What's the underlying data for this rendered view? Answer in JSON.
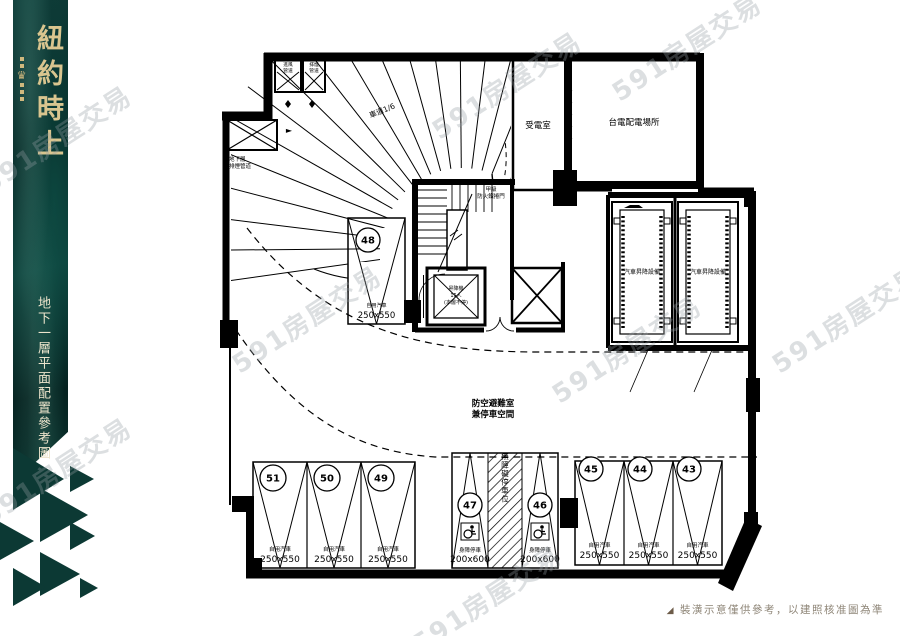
{
  "brand": {
    "title": "紐約時上",
    "crest_glyph": "♛",
    "subtitle": "地下一層平面配置參考圖",
    "panel_color": "#0a332f",
    "accent_color": "#d9c58f"
  },
  "watermark": {
    "text": "591房屋交易"
  },
  "footer": {
    "icon": "◢",
    "text": "裝潢示意僅供參考，以建照核准圖為準"
  },
  "plan": {
    "rooms": {
      "power_room": "受電室",
      "taipower_room": "台電配電場所"
    },
    "ramp_label": "車道1/6",
    "shelter_label_1": "防空避難室",
    "shelter_label_2": "兼停車空間",
    "fire_note_1": "甲級",
    "fire_note_2": "防火鐵捲門",
    "elevator_labels": [
      "昇降機",
      "15人",
      "(本層不停)"
    ],
    "car_lift_label": "汽車昇降設備",
    "shaft_top_labels": [
      [
        "進風",
        "管道"
      ],
      [
        "排煙",
        "管道"
      ]
    ],
    "shaft_left_labels": [
      "地下層",
      "排煙管道"
    ],
    "arrow_glyph": "►",
    "aisle_label": "無障礙停車位",
    "stall_types": {
      "car": "自用汽車",
      "accessible": "身障停車"
    },
    "stall_groups": [
      {
        "id": "g48",
        "numbers": [
          "48"
        ],
        "size": "250x550",
        "type": "car"
      },
      {
        "id": "left",
        "numbers": [
          "51",
          "50",
          "49"
        ],
        "size": "250x550",
        "type": "car"
      },
      {
        "id": "mid",
        "numbers": [
          "47",
          "46"
        ],
        "size": "200x600",
        "type": "accessible"
      },
      {
        "id": "right",
        "numbers": [
          "45",
          "44",
          "43"
        ],
        "size": "250x550",
        "type": "car"
      }
    ]
  }
}
